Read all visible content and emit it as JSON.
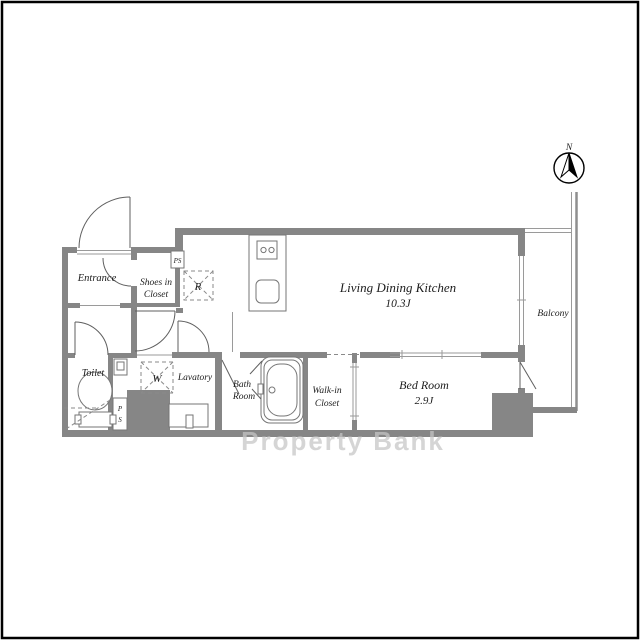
{
  "theme": {
    "bg": "#ffffff",
    "wall": "#868686",
    "line": "#5f5f5f",
    "thin": "#9a9a9a",
    "text": "#1c1c1c",
    "watermark": "#c6c6c6"
  },
  "compass": {
    "north_label": "N"
  },
  "rooms": {
    "entrance": {
      "label": "Entrance"
    },
    "shoes_closet": {
      "line1": "Shoes in",
      "line2": "Closet"
    },
    "ldk": {
      "label": "Living Dining Kitchen",
      "size": "10.3J"
    },
    "balcony": {
      "label": "Balcony"
    },
    "toilet": {
      "label": "Toilet"
    },
    "lavatory": {
      "label": "Lavatory"
    },
    "bath": {
      "line1": "Bath",
      "line2": "Room"
    },
    "walk_in_closet": {
      "line1": "Walk-in",
      "line2": "Closet"
    },
    "bedroom": {
      "label": "Bed Room",
      "size": "2.9J"
    }
  },
  "fixtures": {
    "refrigerator_space": "R",
    "washer_space": "W",
    "pipe_shaft_top": "PS",
    "pipe_shaft_bottom_line1": "P",
    "pipe_shaft_bottom_line2": "S"
  },
  "watermark": "Property Bank"
}
